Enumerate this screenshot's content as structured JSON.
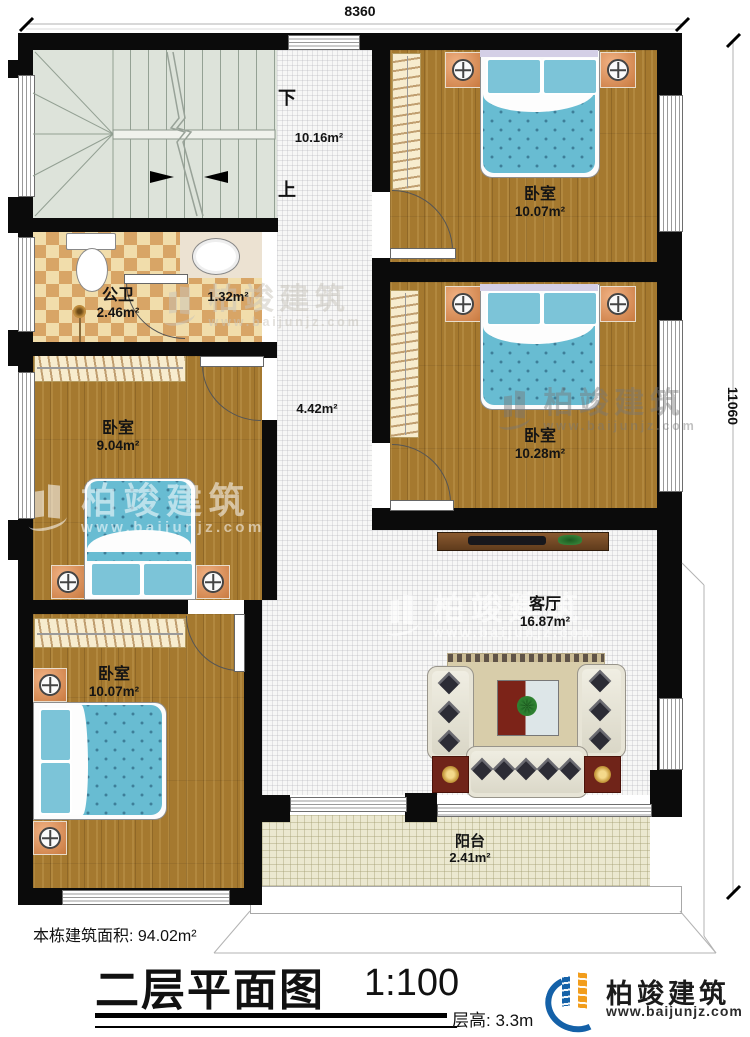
{
  "dimensions": {
    "width_top": "8360",
    "height_right": "11060"
  },
  "stairwell": {
    "down_label": "下",
    "up_label": "上"
  },
  "rooms": {
    "hall": {
      "area": "10.16m²"
    },
    "corridor": {
      "area": "4.42m²"
    },
    "bathroom": {
      "name": "公卫",
      "area": "2.46m²"
    },
    "washroom": {
      "area": "1.32m²"
    },
    "bedroom_top_right": {
      "name": "卧室",
      "area": "10.07m²"
    },
    "bedroom_mid_right": {
      "name": "卧室",
      "area": "10.28m²"
    },
    "bedroom_mid_left": {
      "name": "卧室",
      "area": "9.04m²"
    },
    "bedroom_bottom_left": {
      "name": "卧室",
      "area": "10.07m²"
    },
    "living_room": {
      "name": "客厅",
      "area": "16.87m²"
    },
    "balcony": {
      "name": "阳台",
      "area": "2.41m²"
    }
  },
  "footer": {
    "total_area": "本栋建筑面积: 94.02m²",
    "title": "二层平面图",
    "scale": "1:100",
    "floor_height": "层高: 3.3m",
    "brand": "柏竣建筑",
    "brand_url": "www.baijunjz.com"
  },
  "watermark": {
    "brand": "柏竣建筑",
    "url": "www.baijunjz.com"
  }
}
